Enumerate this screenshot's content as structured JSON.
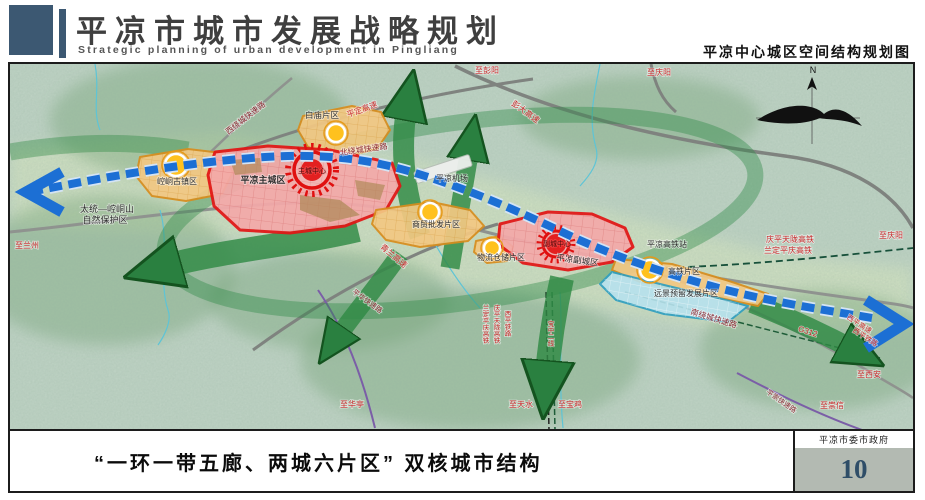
{
  "header": {
    "title": "平凉市城市发展战略规划",
    "subtitle": "Strategic planning of urban development in Pingliang",
    "map_name": "平凉中心城区空间结构规划图"
  },
  "footer": {
    "caption": "“一环一带五廊、两城六片区” 双核城市结构",
    "agency": "平凉市委市政府",
    "page_number": "10"
  },
  "colors": {
    "accent_red": "#e31515",
    "zone_red_fill": "#f4a9a9",
    "zone_orange_fill": "#f3c883",
    "zone_orange_stroke": "#d88d1d",
    "zone_blue_fill": "#b7e2ee",
    "belt_blue": "#1c6fd4",
    "corridor_green": "#2f8a44",
    "terrain_green": "#c3d6c8",
    "header_slate": "#3c5872",
    "page_box_gray": "#b3bab2",
    "page_number_blue": "#2f4e68"
  },
  "map": {
    "compass_label": "N",
    "labels": [
      {
        "t": "至兰州",
        "x": 27,
        "y": 248,
        "c": "red",
        "s": 8
      },
      {
        "t": "太统—崆峒山",
        "x": 107,
        "y": 212,
        "c": "dark",
        "s": 9
      },
      {
        "t": "自然保护区",
        "x": 105,
        "y": 223,
        "c": "dark",
        "s": 9
      },
      {
        "t": "西绕城快速路",
        "x": 247,
        "y": 120,
        "c": "maroon",
        "s": 8,
        "r": -38
      },
      {
        "t": "平定高速",
        "x": 363,
        "y": 112,
        "c": "red",
        "s": 8,
        "r": -20
      },
      {
        "t": "白庙片区",
        "x": 322,
        "y": 118,
        "c": "dark",
        "s": 8.5
      },
      {
        "t": "北绕城快速路",
        "x": 364,
        "y": 152,
        "c": "maroon",
        "s": 8,
        "r": -8
      },
      {
        "t": "彭大高速",
        "x": 524,
        "y": 114,
        "c": "red",
        "s": 8,
        "r": 36
      },
      {
        "t": "至彭阳",
        "x": 487,
        "y": 73,
        "c": "red",
        "s": 8
      },
      {
        "t": "至庆阳",
        "x": 659,
        "y": 75,
        "c": "red",
        "s": 8
      },
      {
        "t": "平凉机场",
        "x": 452,
        "y": 181,
        "c": "dark",
        "s": 8
      },
      {
        "t": "平凉主城区",
        "x": 263,
        "y": 183,
        "c": "dark",
        "s": 9,
        "b": true
      },
      {
        "t": "主城中心",
        "x": 312,
        "y": 173,
        "c": "centerlabel",
        "s": 7
      },
      {
        "t": "崆峒古镇区",
        "x": 177,
        "y": 184,
        "c": "dark",
        "s": 8
      },
      {
        "t": "青兰高速",
        "x": 392,
        "y": 258,
        "c": "red",
        "s": 8,
        "r": 40
      },
      {
        "t": "商贸批发片区",
        "x": 436,
        "y": 227,
        "c": "dark",
        "s": 8
      },
      {
        "t": "物流仓储片区",
        "x": 501,
        "y": 260,
        "c": "dark",
        "s": 8
      },
      {
        "t": "副城中心",
        "x": 557,
        "y": 246,
        "c": "centerlabel",
        "s": 7
      },
      {
        "t": "平凉副城区",
        "x": 577,
        "y": 263,
        "c": "dark",
        "s": 8.5,
        "r": 8
      },
      {
        "t": "平凉高铁站",
        "x": 667,
        "y": 247,
        "c": "dark",
        "s": 8
      },
      {
        "t": "庆平天陇高铁",
        "x": 790,
        "y": 242,
        "c": "red",
        "s": 8
      },
      {
        "t": "兰定平庆高铁",
        "x": 788,
        "y": 253,
        "c": "red",
        "s": 8
      },
      {
        "t": "至庆阳",
        "x": 891,
        "y": 238,
        "c": "red",
        "s": 8
      },
      {
        "t": "高铁片区",
        "x": 684,
        "y": 274,
        "c": "dark",
        "s": 8
      },
      {
        "t": "远景预留发展片区",
        "x": 686,
        "y": 296,
        "c": "dark",
        "s": 8
      },
      {
        "t": "南绕城快速路",
        "x": 713,
        "y": 321,
        "c": "maroon",
        "s": 8,
        "r": 17
      },
      {
        "t": "G312",
        "x": 807,
        "y": 334,
        "c": "red",
        "s": 8,
        "r": 18
      },
      {
        "t": "西平高速",
        "x": 858,
        "y": 326,
        "c": "red",
        "s": 7,
        "r": 33
      },
      {
        "t": "西平铁路",
        "x": 864,
        "y": 339,
        "c": "red",
        "s": 7,
        "r": 33
      },
      {
        "t": "至西安",
        "x": 869,
        "y": 377,
        "c": "red",
        "s": 8
      },
      {
        "t": "平崇快速路",
        "x": 780,
        "y": 403,
        "c": "maroon",
        "s": 7,
        "r": 35
      },
      {
        "t": "至崇信",
        "x": 832,
        "y": 408,
        "c": "red",
        "s": 8
      },
      {
        "t": "平华快速路",
        "x": 366,
        "y": 303,
        "c": "maroon",
        "s": 7,
        "r": 36
      },
      {
        "t": "至华亭",
        "x": 352,
        "y": 407,
        "c": "red",
        "s": 8
      },
      {
        "t": "至天水",
        "x": 521,
        "y": 407,
        "c": "red",
        "s": 8
      },
      {
        "t": "至宝鸡",
        "x": 570,
        "y": 407,
        "c": "red",
        "s": 8
      },
      {
        "t": "兰定平庆高铁",
        "x": 486,
        "y": 310,
        "c": "red",
        "s": 6.5,
        "v": true
      },
      {
        "t": "庆平天陇高铁",
        "x": 497,
        "y": 310,
        "c": "red",
        "s": 6.5,
        "v": true
      },
      {
        "t": "西平铁路",
        "x": 508,
        "y": 316,
        "c": "red",
        "s": 6.5,
        "v": true
      },
      {
        "t": "宝中二线",
        "x": 551,
        "y": 326,
        "c": "red",
        "s": 6.5,
        "v": true
      }
    ]
  }
}
